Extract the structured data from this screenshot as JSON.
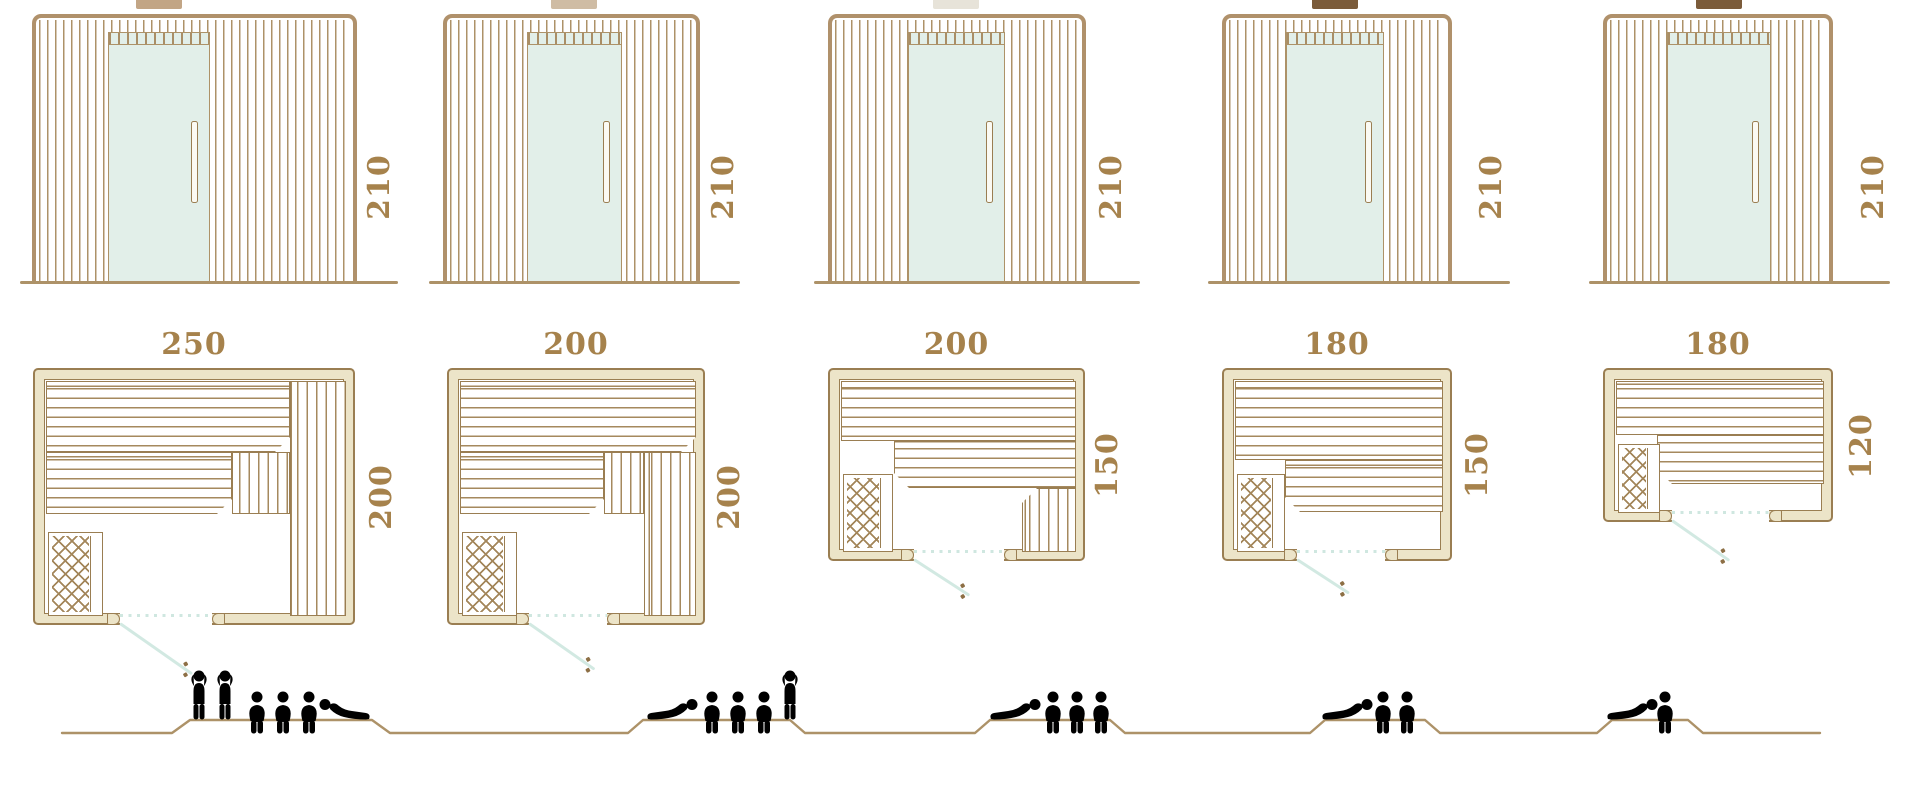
{
  "figure": {
    "kind": "sauna size diagram",
    "rows": [
      "front elevations",
      "floor plans",
      "seating capacity"
    ]
  },
  "colors": {
    "wood_line": "#ad9268",
    "outline": "#9a7e52",
    "wall_fill": "#ece4c8",
    "bench_line": "#a5895e",
    "glass": "#e2efe9",
    "door_teal": "#d2e9e2",
    "dimension_text": "#a6824c",
    "people_outline": "#a8906b"
  },
  "saunas": [
    {
      "height_cm": "210",
      "width_cm": "250",
      "depth_cm": "200",
      "capacity": {
        "standing": 2,
        "sitting": 3,
        "lying": 1
      }
    },
    {
      "height_cm": "210",
      "width_cm": "200",
      "depth_cm": "200",
      "capacity": {
        "standing": 1,
        "sitting": 3,
        "lying": 1
      }
    },
    {
      "height_cm": "210",
      "width_cm": "200",
      "depth_cm": "150",
      "capacity": {
        "standing": 0,
        "sitting": 3,
        "lying": 1
      }
    },
    {
      "height_cm": "210",
      "width_cm": "180",
      "depth_cm": "150",
      "capacity": {
        "standing": 0,
        "sitting": 2,
        "lying": 1
      }
    },
    {
      "height_cm": "210",
      "width_cm": "180",
      "depth_cm": "120",
      "capacity": {
        "standing": 0,
        "sitting": 1,
        "lying": 1
      }
    }
  ]
}
